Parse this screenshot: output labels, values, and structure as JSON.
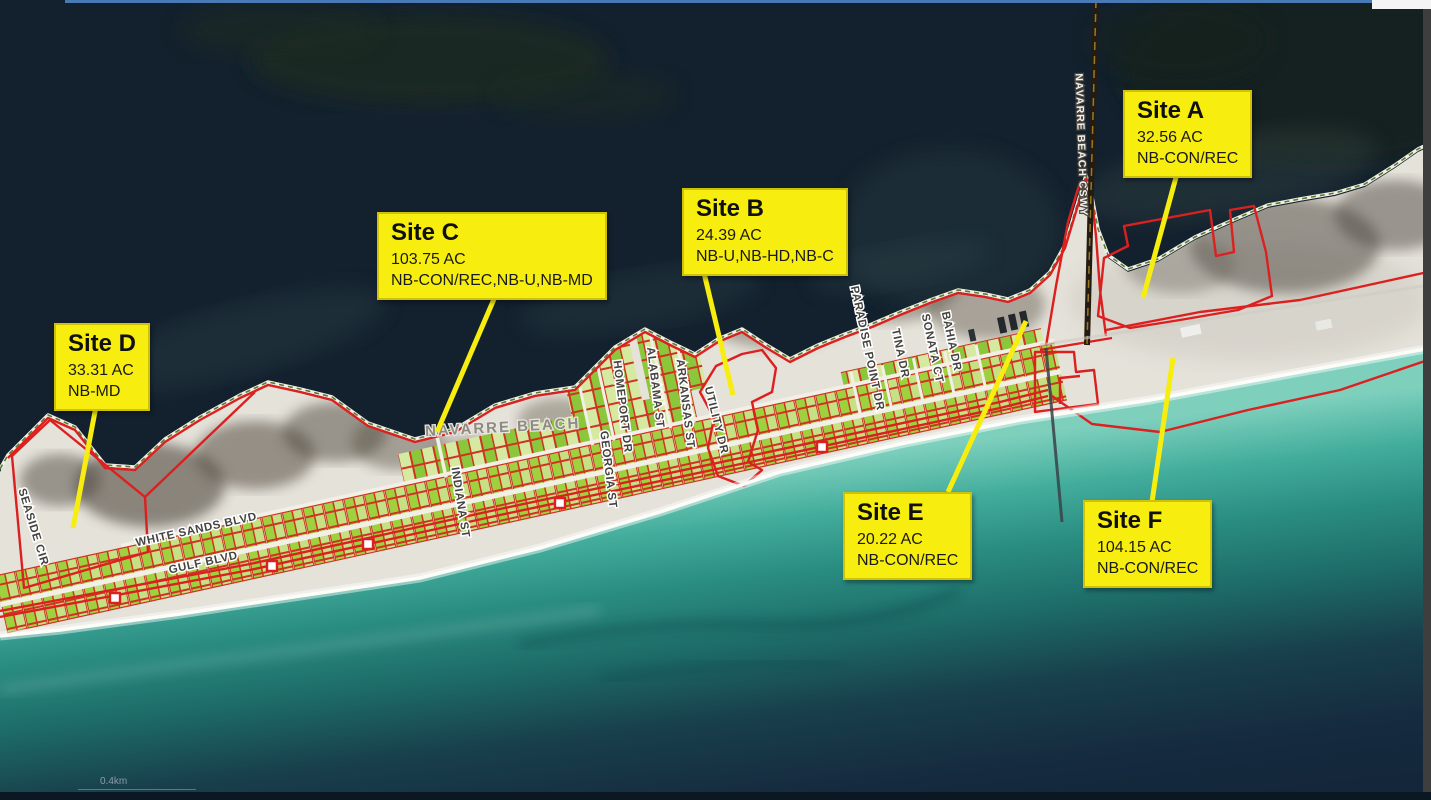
{
  "sites": [
    {
      "name": "Site A",
      "acreage": "32.56 AC",
      "zoning": "NB-CON/REC"
    },
    {
      "name": "Site B",
      "acreage": "24.39 AC",
      "zoning": "NB-U,NB-HD,NB-C"
    },
    {
      "name": "Site C",
      "acreage": "103.75 AC",
      "zoning": "NB-CON/REC,NB-U,NB-MD"
    },
    {
      "name": "Site D",
      "acreage": "33.31 AC",
      "zoning": "NB-MD"
    },
    {
      "name": "Site E",
      "acreage": "20.22 AC",
      "zoning": "NB-CON/REC"
    },
    {
      "name": "Site F",
      "acreage": "104.15 AC",
      "zoning": "NB-CON/REC"
    }
  ],
  "streets": {
    "seaside_cir": "SEASIDE CIR",
    "white_sands_blvd": "WHITE SANDS BLVD",
    "gulf_blvd": "GULF BLVD",
    "indiana_st": "INDIANA ST",
    "homeport_dr": "HOMEPORT DR",
    "georgia_st": "GEORGIA ST",
    "alabama_st": "ALABAMA ST",
    "arkansas_st": "ARKANSAS ST",
    "utility_dr": "UTILITY DR",
    "paradise_point_dr": "PARADISE POINT DR",
    "tina_dr": "TINA DR",
    "sonata_ct": "SONATA CT",
    "bahia_dr": "BAHIA DR",
    "navarre_beach_cswy": "NAVARRE BEACH CSWY"
  },
  "places": {
    "navarre_beach": "NAVARRE BEACH"
  },
  "scale": {
    "label": "0.4km"
  },
  "colors": {
    "callout_bg": "#f7ee0f",
    "boundary_red": "#dc2020",
    "sound_water": "#13212e",
    "gulf_nearshore": "#43ad9c",
    "sand": "#e5e2da",
    "parcel_green": "#9ed13d"
  }
}
